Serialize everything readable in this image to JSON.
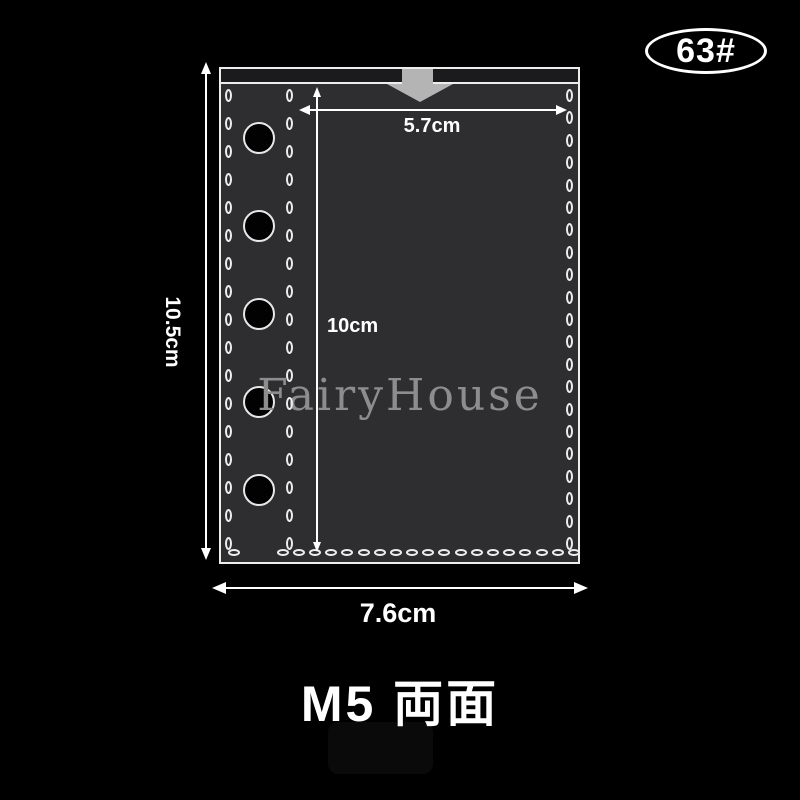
{
  "badge": {
    "label": "63#"
  },
  "product": {
    "watermark": "FairyHouse",
    "holes_count": 5,
    "description": "black binder zipper pocket with white stitching and ring holes",
    "colors": {
      "background": "#000000",
      "pouch_body": "#2e2e30",
      "pouch_flap": "#1b1b1d",
      "stitch": "#ededed",
      "insert_arrow": "#b4b4b4",
      "watermark": "#8d8d8d",
      "dimension": "#ffffff"
    }
  },
  "dimensions": {
    "outer_height": "10.5cm",
    "outer_width": "7.6cm",
    "inner_width": "5.7cm",
    "inner_height": "10cm"
  },
  "title": "M5 両面"
}
